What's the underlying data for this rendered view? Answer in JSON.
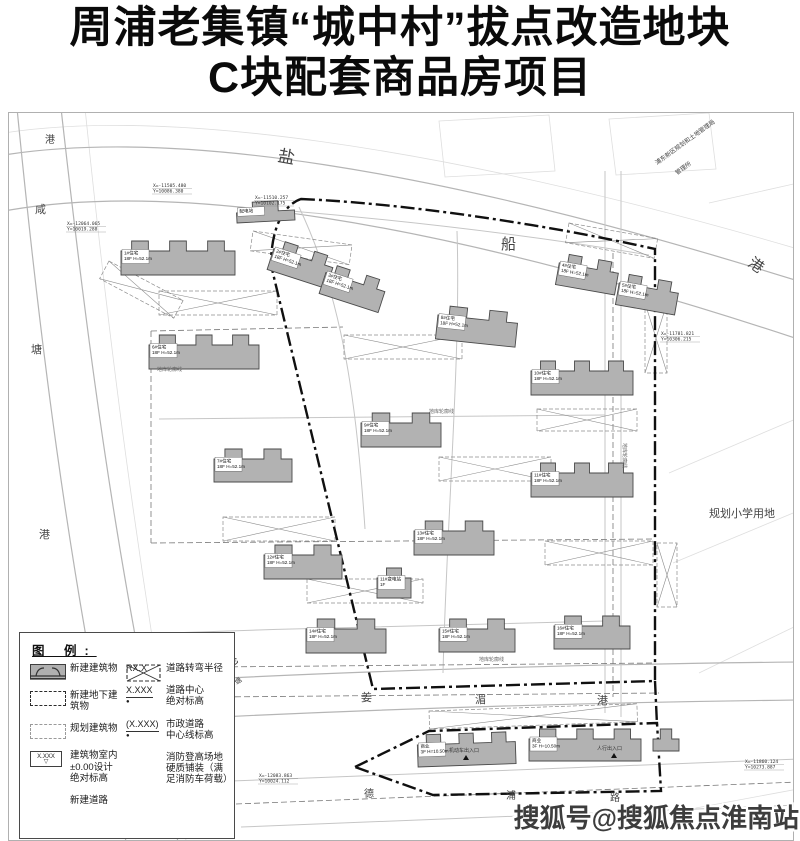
{
  "title": {
    "line1": "周浦老集镇“城中村”拔点改造地块",
    "line2": "C块配套商品房项目"
  },
  "watermark": {
    "text": "搜狐号@搜狐焦点淮南站"
  },
  "colors": {
    "building_fill": "#b2b2b2",
    "building_stroke": "#4a4a4a",
    "boundary": "#101010",
    "river_line": "#b5b5b5",
    "road_line": "#c6c6c6",
    "bg_line": "#dedede",
    "hatch": "#8c8c8c",
    "text": "#3a3a3a"
  },
  "legend": {
    "title": "图 例:",
    "left": [
      {
        "symbol": "new-building",
        "label": "新建建筑物"
      },
      {
        "symbol": "new-underground-building",
        "label": "新建地下建筑物"
      },
      {
        "symbol": "planned-building",
        "label": "规划建筑物"
      },
      {
        "symbol": "indoor-level",
        "symbol_text": "X.XXX",
        "label": "建筑物室内\n±0.00设计\n绝对标高"
      },
      {
        "symbol": "new-road",
        "label": "新建道路"
      }
    ],
    "right": [
      {
        "symbol_text": "RX.X",
        "label": "道路转弯半径"
      },
      {
        "symbol_text": "X.XXX",
        "dot": "●",
        "label": "道路中心\n绝对标高"
      },
      {
        "symbol_text": "(X.XXX)",
        "dot": "●",
        "label": "市政道路\n中心线标高"
      },
      {
        "symbol": "fire-lane",
        "label": "消防登高场地\n硬质铺装（满\n足消防车荷载）"
      }
    ]
  },
  "plan": {
    "bg_paths": [
      "M-5,20 C150,-4 420,28 789,136",
      "M76,-5 C96,190 124,430 178,733",
      "M430,8 L540,2 L546,58 L436,64 Z",
      "M600,6 L700,0 L707,56 L607,62 Z",
      "M700,90 L789,70",
      "M660,360 L789,305",
      "M664,450 L789,398",
      "M690,560 L789,512",
      "M660,700 L789,676"
    ],
    "river_paths": [
      "M-5,42 C160,16 420,52 789,168",
      "M-5,98 C160,68 420,104 789,226",
      "M8,-5 C28,200 58,460 118,733",
      "M52,-5 C76,210 108,470 170,733",
      "M198,566 C400,556 600,551 789,549",
      "M210,604 C420,594 620,589 789,587"
    ],
    "road_paths": [
      "M282,98 C400,108 520,122 640,142",
      "M290,94 C336,190 348,300 356,416",
      "M448,118 C452,240 438,400 434,560",
      "M596,58 L596,600",
      "M612,58 L612,604",
      "M150,306 L596,302",
      "M160,520 C300,515 420,512 596,508",
      "M222,668 L789,646",
      "M232,714 L789,692"
    ],
    "dashed_paths": [
      "M142,218 L142,430",
      "M142,430 L645,426",
      "M205,554 L646,550",
      "M208,584 L650,580",
      "M604,140 L604,584",
      "M142,218 L334,214",
      "M227,691 L789,669"
    ],
    "boundary_paths": [
      "M292,86 C390,90 530,110 646,136 L646,568 L364,576 L262,152 C262,116 274,92 292,86 Z",
      "M346,654 L420,618 L648,610 L652,678 L424,682 Z",
      "M646,568 L648,612"
    ],
    "buildings": [
      {
        "x": 112,
        "y": 128,
        "w": 114,
        "h": 34,
        "r": 0,
        "bumps": 3,
        "label": "1#住宅\n18F H=52.1m"
      },
      {
        "x": 268,
        "y": 126,
        "w": 62,
        "h": 32,
        "r": 18,
        "bumps": 2,
        "label": "2#住宅\n18F H=52.1m"
      },
      {
        "x": 320,
        "y": 150,
        "w": 62,
        "h": 32,
        "r": 18,
        "bumps": 2,
        "label": "3#住宅\n18F H=52.1m"
      },
      {
        "x": 552,
        "y": 140,
        "w": 60,
        "h": 32,
        "r": 10,
        "bumps": 2,
        "label": "4#住宅\n18F H=52.1m"
      },
      {
        "x": 612,
        "y": 160,
        "w": 60,
        "h": 32,
        "r": 10,
        "bumps": 2,
        "label": "5#住宅\n18F H=52.1m"
      },
      {
        "x": 140,
        "y": 222,
        "w": 110,
        "h": 34,
        "r": 0,
        "bumps": 3,
        "label": "6#住宅\n18F H=52.1m"
      },
      {
        "x": 205,
        "y": 336,
        "w": 78,
        "h": 33,
        "r": 0,
        "bumps": 2,
        "label": "7#住宅\n18F H=52.1m"
      },
      {
        "x": 430,
        "y": 192,
        "w": 80,
        "h": 34,
        "r": 6,
        "bumps": 2,
        "label": "8#住宅\n18F H=52.1m"
      },
      {
        "x": 352,
        "y": 300,
        "w": 80,
        "h": 34,
        "r": 0,
        "bumps": 2,
        "label": "9#住宅\n18F H=52.1m"
      },
      {
        "x": 522,
        "y": 248,
        "w": 102,
        "h": 34,
        "r": 0,
        "bumps": 3,
        "label": "10#住宅\n18F H=52.1m"
      },
      {
        "x": 522,
        "y": 350,
        "w": 102,
        "h": 34,
        "r": 0,
        "bumps": 3,
        "label": "11#住宅\n18F H=52.1m"
      },
      {
        "x": 255,
        "y": 432,
        "w": 78,
        "h": 34,
        "r": 0,
        "bumps": 2,
        "label": "12#住宅\n18F H=52.1m"
      },
      {
        "x": 405,
        "y": 408,
        "w": 80,
        "h": 34,
        "r": 0,
        "bumps": 2,
        "label": "13#住宅\n18F H=52.1m"
      },
      {
        "x": 297,
        "y": 506,
        "w": 80,
        "h": 34,
        "r": 0,
        "bumps": 2,
        "label": "14#住宅\n18F H=52.1m"
      },
      {
        "x": 430,
        "y": 506,
        "w": 76,
        "h": 33,
        "r": 0,
        "bumps": 2,
        "label": "15#住宅\n18F H=52.1m"
      },
      {
        "x": 545,
        "y": 503,
        "w": 76,
        "h": 33,
        "r": 0,
        "bumps": 2,
        "label": "16#住宅\n18F H=52.1m"
      },
      {
        "x": 368,
        "y": 455,
        "w": 34,
        "h": 30,
        "r": 0,
        "bumps": 1,
        "label": "11#变电站\n1F"
      },
      {
        "x": 227,
        "y": 90,
        "w": 58,
        "h": 20,
        "r": -3,
        "bumps": 1,
        "label": "配电站"
      },
      {
        "x": 408,
        "y": 622,
        "w": 98,
        "h": 32,
        "r": -2,
        "bumps": 3,
        "label": "商业\n3F H=10.50m"
      },
      {
        "x": 520,
        "y": 616,
        "w": 112,
        "h": 32,
        "r": 0,
        "bumps": 3,
        "label": "商业\n3F H=10.50m"
      },
      {
        "x": 644,
        "y": 616,
        "w": 26,
        "h": 22,
        "r": 0,
        "bumps": 1,
        "label": ""
      }
    ],
    "hatches": [
      {
        "x": 150,
        "y": 178,
        "w": 118,
        "h": 24,
        "r": 0
      },
      {
        "x": 244,
        "y": 118,
        "w": 100,
        "h": 20,
        "r": 8
      },
      {
        "x": 335,
        "y": 222,
        "w": 118,
        "h": 24,
        "r": 0
      },
      {
        "x": 214,
        "y": 404,
        "w": 112,
        "h": 24,
        "r": 0
      },
      {
        "x": 430,
        "y": 344,
        "w": 112,
        "h": 24,
        "r": 0
      },
      {
        "x": 298,
        "y": 466,
        "w": 116,
        "h": 24,
        "r": 0
      },
      {
        "x": 528,
        "y": 296,
        "w": 100,
        "h": 22,
        "r": 0
      },
      {
        "x": 536,
        "y": 428,
        "w": 108,
        "h": 24,
        "r": 0
      },
      {
        "x": 100,
        "y": 148,
        "w": 84,
        "h": 20,
        "r": 28
      },
      {
        "x": 560,
        "y": 110,
        "w": 90,
        "h": 20,
        "r": 10
      },
      {
        "x": 636,
        "y": 190,
        "w": 22,
        "h": 70,
        "r": 0
      },
      {
        "x": 648,
        "y": 430,
        "w": 20,
        "h": 64,
        "r": 0
      },
      {
        "x": 420,
        "y": 598,
        "w": 208,
        "h": 18,
        "r": -2
      }
    ],
    "area_labels": [
      {
        "text": "盐",
        "x": 268,
        "y": 48,
        "s": 17,
        "r": 10
      },
      {
        "text": "船",
        "x": 492,
        "y": 136,
        "s": 15,
        "r": 0
      },
      {
        "text": "港",
        "x": 738,
        "y": 152,
        "s": 15,
        "r": 35
      },
      {
        "text": "港",
        "x": 36,
        "y": 30,
        "s": 10,
        "r": 0
      },
      {
        "text": "咸",
        "x": 26,
        "y": 100,
        "s": 11,
        "r": 0
      },
      {
        "text": "塘",
        "x": 22,
        "y": 240,
        "s": 11,
        "r": 0
      },
      {
        "text": "港",
        "x": 30,
        "y": 425,
        "s": 11,
        "r": 0
      },
      {
        "text": "港",
        "x": 220,
        "y": 556,
        "s": 13,
        "r": -40
      },
      {
        "text": "塘",
        "x": 228,
        "y": 572,
        "s": 7,
        "r": -40
      },
      {
        "text": "姜",
        "x": 352,
        "y": 588,
        "s": 11,
        "r": 0
      },
      {
        "text": "湄",
        "x": 466,
        "y": 590,
        "s": 11,
        "r": 0
      },
      {
        "text": "港",
        "x": 588,
        "y": 591,
        "s": 11,
        "r": 0
      },
      {
        "text": "德",
        "x": 355,
        "y": 684,
        "s": 10,
        "r": 0
      },
      {
        "text": "浦",
        "x": 497,
        "y": 686,
        "s": 10,
        "r": 0
      },
      {
        "text": "路",
        "x": 601,
        "y": 688,
        "s": 10,
        "r": 0
      },
      {
        "text": "规划小学用地",
        "x": 700,
        "y": 404,
        "s": 11,
        "r": 0
      },
      {
        "text": "浦东新区规划和土地管理局",
        "x": 648,
        "y": 52,
        "s": 6,
        "r": -36
      },
      {
        "text": "管理所",
        "x": 668,
        "y": 62,
        "s": 6,
        "r": -36
      }
    ],
    "coord_labels": [
      {
        "l1": "X=-11505.480",
        "l2": "Y=10086.380",
        "x": 144,
        "y": 74
      },
      {
        "l1": "X=-11510.257",
        "l2": "Y=10102.175",
        "x": 246,
        "y": 86
      },
      {
        "l1": "X=-12064.065",
        "l2": "Y=10019.288",
        "x": 58,
        "y": 112
      },
      {
        "l1": "X=-11781.821",
        "l2": "Y=10306.215",
        "x": 652,
        "y": 222
      },
      {
        "l1": "X=-12031.135",
        "l2": "Y=10278.270",
        "x": 118,
        "y": 560
      },
      {
        "l1": "X=-12033.579",
        "l2": "Y=10282.187",
        "x": 112,
        "y": 586
      },
      {
        "l1": "X=-12083.863",
        "l2": "Y=10024.112",
        "x": 250,
        "y": 664
      },
      {
        "l1": "X=-11860.124",
        "l2": "Y=10273.887",
        "x": 736,
        "y": 650
      }
    ],
    "note_labels": [
      {
        "text": "地库轮廓线",
        "x": 148,
        "y": 258,
        "r": 0
      },
      {
        "text": "地库轮廓线",
        "x": 420,
        "y": 300,
        "r": 0
      },
      {
        "text": "地库轮廓线",
        "x": 470,
        "y": 548,
        "r": 0
      },
      {
        "text": "地库轮廓线",
        "x": 614,
        "y": 330,
        "r": 90
      }
    ],
    "entrances": [
      {
        "text": "机动车出入口",
        "x": 440,
        "y": 641
      },
      {
        "text": "人行出入口",
        "x": 588,
        "y": 639
      }
    ]
  }
}
